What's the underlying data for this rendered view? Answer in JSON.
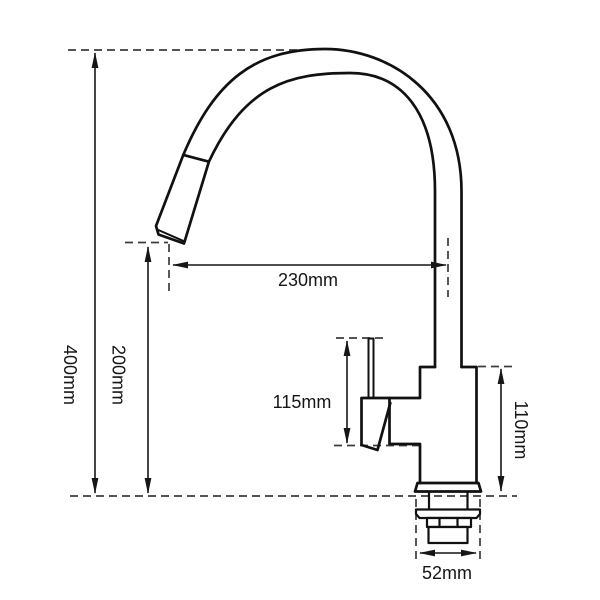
{
  "drawing": {
    "dimensions": {
      "overall_height": "400mm",
      "spout_height": "200mm",
      "spout_reach": "230mm",
      "handle_height": "115mm",
      "body_height": "110mm",
      "base_diameter": "52mm"
    },
    "colors": {
      "line": "#111111",
      "dimension": "#161616",
      "dashed": "#3c3c3c",
      "background": "#ffffff"
    }
  }
}
